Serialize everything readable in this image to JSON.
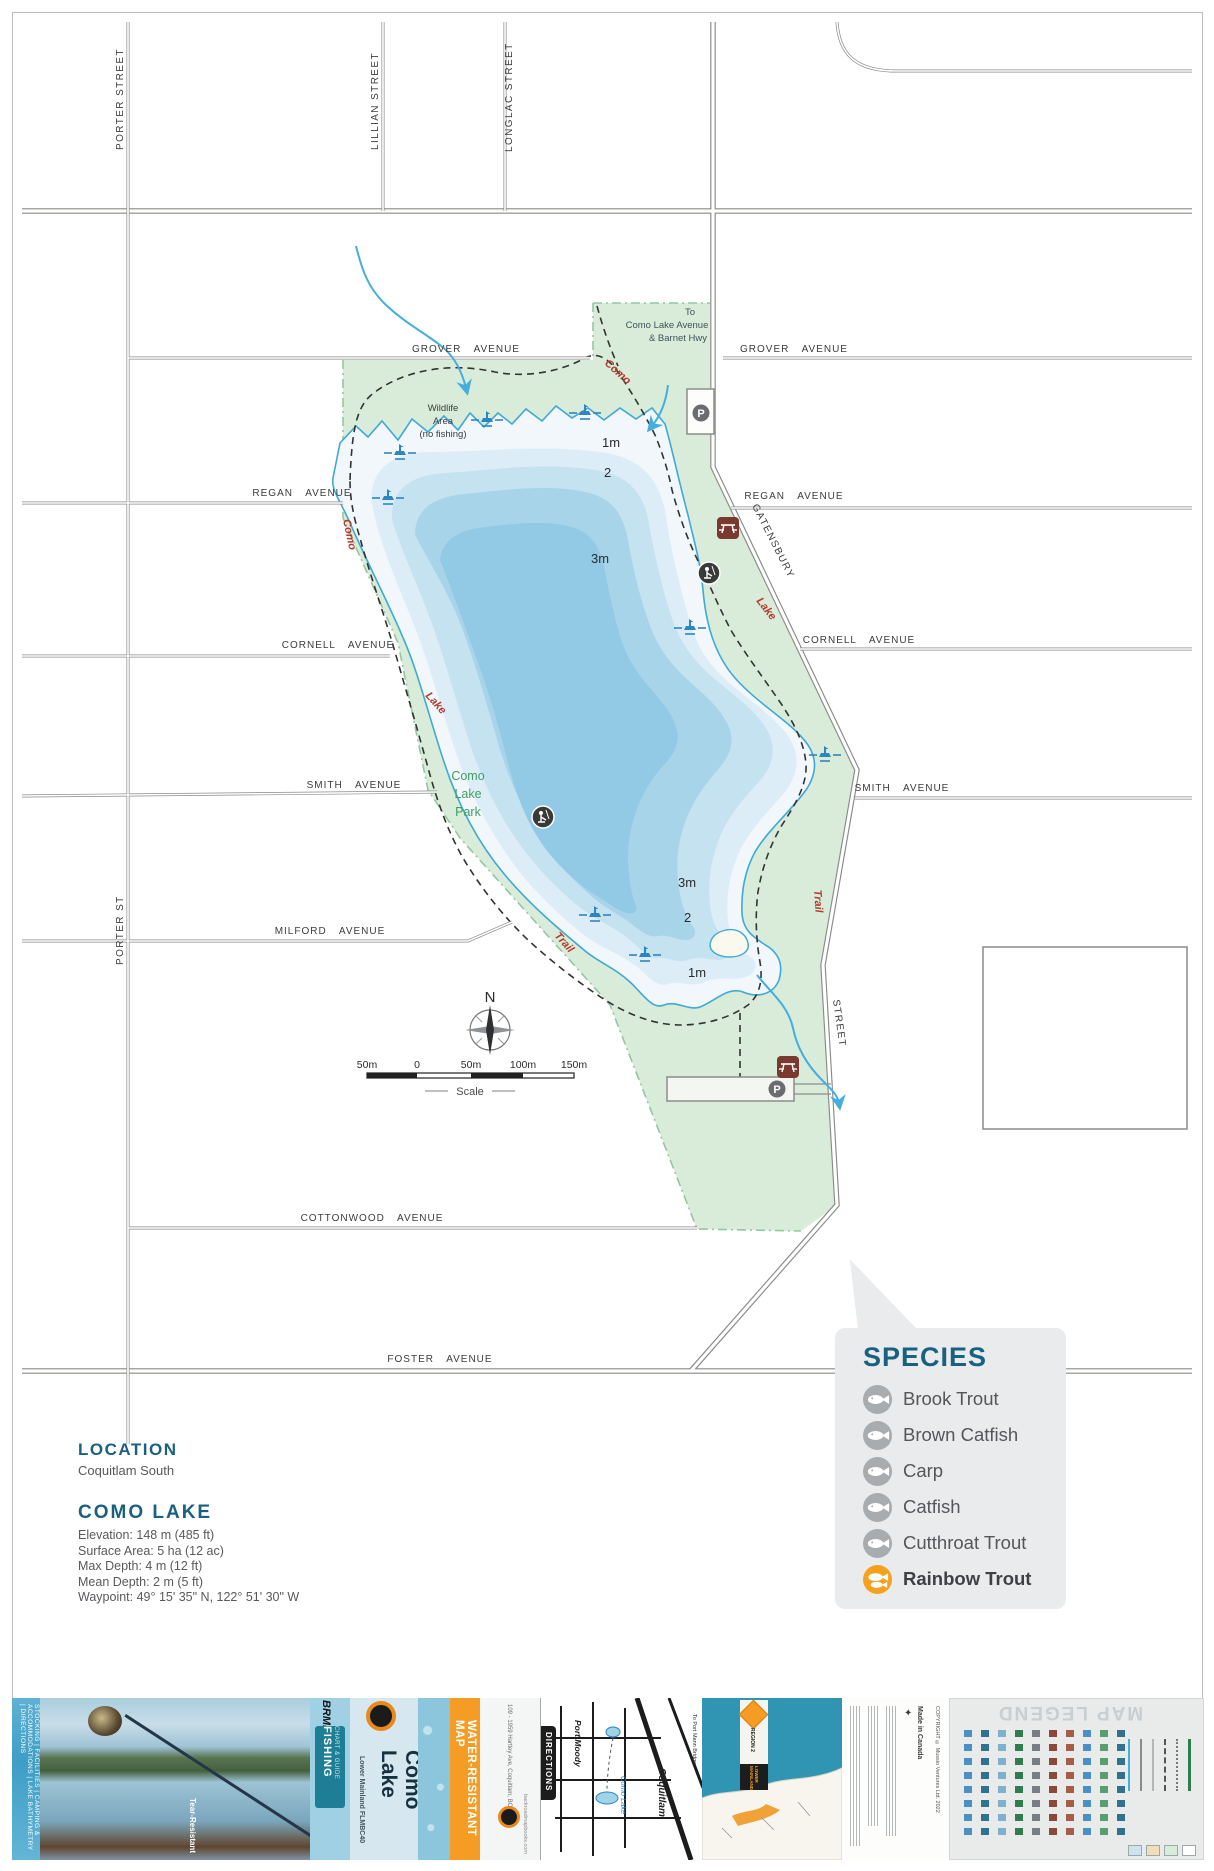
{
  "map": {
    "streets": {
      "porter_top": "PORTER STREET",
      "lillian": "LILLIAN STREET",
      "longlac": "LONGLAC STREET",
      "porter_mid": "PORTER ST",
      "gatensbury": "GATENSBURY",
      "gatensbury_street": "STREET"
    },
    "avenues": {
      "grover": "GROVER AVENUE",
      "regan": "REGAN AVENUE",
      "cornell": "CORNELL AVENUE",
      "smith": "SMITH AVENUE",
      "milford": "MILFORD AVENUE",
      "cottonwood": "COTTONWOOD AVENUE",
      "foster": "FOSTER AVENUE"
    },
    "notes": {
      "to_destination": [
        "To",
        "Como Lake Avenue",
        "& Barnet Hwy"
      ],
      "wildlife": [
        "Wildlife",
        "Area",
        "(no fishing)"
      ],
      "park": [
        "Como",
        "Lake",
        "Park"
      ]
    },
    "trail_labels": {
      "como": "Como",
      "lake": "Lake",
      "trail": "Trail"
    },
    "depths": {
      "north": [
        "1m",
        "2",
        "3m"
      ],
      "south": [
        "3m",
        "2",
        "1m"
      ]
    },
    "compass": "N",
    "scale": {
      "ticks": [
        "50m",
        "0",
        "50m",
        "100m",
        "150m"
      ],
      "label": "Scale"
    },
    "parking_symbol": "P"
  },
  "species_panel": {
    "title": "SPECIES",
    "items": [
      {
        "name": "Brook Trout"
      },
      {
        "name": "Brown Catfish"
      },
      {
        "name": "Carp"
      },
      {
        "name": "Catfish"
      },
      {
        "name": "Cutthroat Trout"
      },
      {
        "name": "Rainbow Trout"
      }
    ]
  },
  "info": {
    "location_title": "LOCATION",
    "location_value": "Coquitlam South",
    "lake_title": "COMO LAKE",
    "stats": [
      "Elevation: 148 m (485 ft)",
      "Surface Area: 5 ha (12 ac)",
      "Max Depth: 4 m (12 ft)",
      "Mean Depth: 2 m (5 ft)",
      "Waypoint: 49° 15' 35\" N, 122° 51' 30\" W"
    ]
  },
  "footer": {
    "spine_features": "FISHING HOT SPOTS | SPECIES & STOCKING | FACILITIES | CAMPING & ACCOMMODATIONS | LAKE BATHYMETRY | DIRECTIONS",
    "tear_resistant": "Tear-Resistant",
    "brand": "BRMB",
    "series": "FISHING",
    "series_sub": "CHART & GUIDE",
    "title": "Como Lake",
    "subtitle": "Lower Mainland FLMBC40",
    "water_resistant": "WATER-RESISTANT MAP",
    "address": "109 - 1959 Hartley Ave, Coquitlam, BC",
    "website": "backroadmapbooks.com",
    "directions": "DIRECTIONS",
    "inset": {
      "port_moody": "Port Moody",
      "como_lake": "Como Lake",
      "coquitlam": "Coquitlam",
      "to_note": "To Port Mann Bridge"
    },
    "region_line1": "REGION 2",
    "region_line2": "LOWER MAINLAND",
    "legend_title": "MAP LEGEND",
    "made_in": "Made in Canada",
    "copyright": "COPYRIGHT © Mussio Ventures Ltd. 2022"
  }
}
